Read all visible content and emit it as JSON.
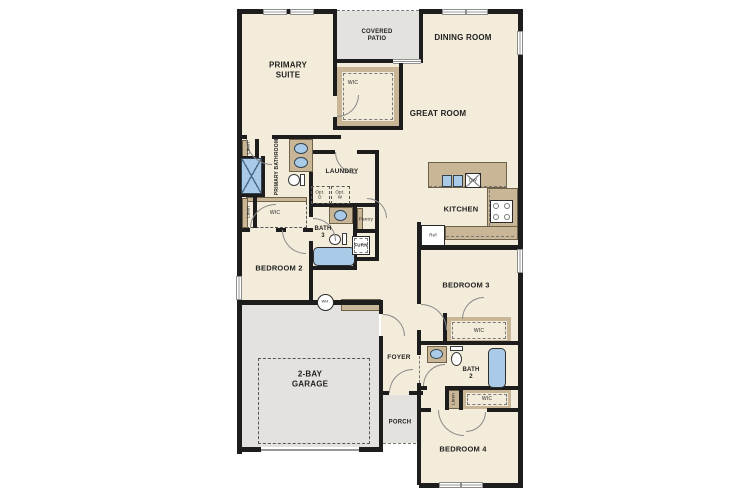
{
  "plan": {
    "labels": {
      "primary_suite": "PRIMARY\nSUITE",
      "covered_patio": "COVERED\nPATIO",
      "dining_room": "DINING ROOM",
      "great_room": "GREAT ROOM",
      "kitchen": "KITCHEN",
      "laundry": "LAUNDRY",
      "primary_bathroom": "PRIMARY\nBATHROOM",
      "bath_3": "BATH\n3",
      "bath_2": "BATH\n2",
      "bedroom_2": "BEDROOM 2",
      "bedroom_3": "BEDROOM 3",
      "bedroom_4": "BEDROOM 4",
      "garage": "2-BAY\nGARAGE",
      "foyer": "FOYER",
      "porch": "PORCH",
      "wic_primary": "WIC",
      "wic_primary2": "WIC",
      "wic_bed3": "WIC",
      "wic_bed4": "WIC",
      "linen_1": "Linen",
      "linen_2": "Linen",
      "linen_3": "Linen",
      "pantry": "Pantry",
      "furnace": "FURN",
      "opt_dryer": "Opt.\nD",
      "opt_washer": "Opt.\nW",
      "dishwasher": "DW",
      "refrigerator": "Ref",
      "water_heater": "WH"
    },
    "colors": {
      "wall": "#1d1d1d",
      "floor": "#f3ecda",
      "open_area_gray": "#e3e2df",
      "casework_tan": "#c9b697",
      "fixture_blue": "#a9cbe8",
      "door_arc": "#8a8a8a"
    }
  }
}
